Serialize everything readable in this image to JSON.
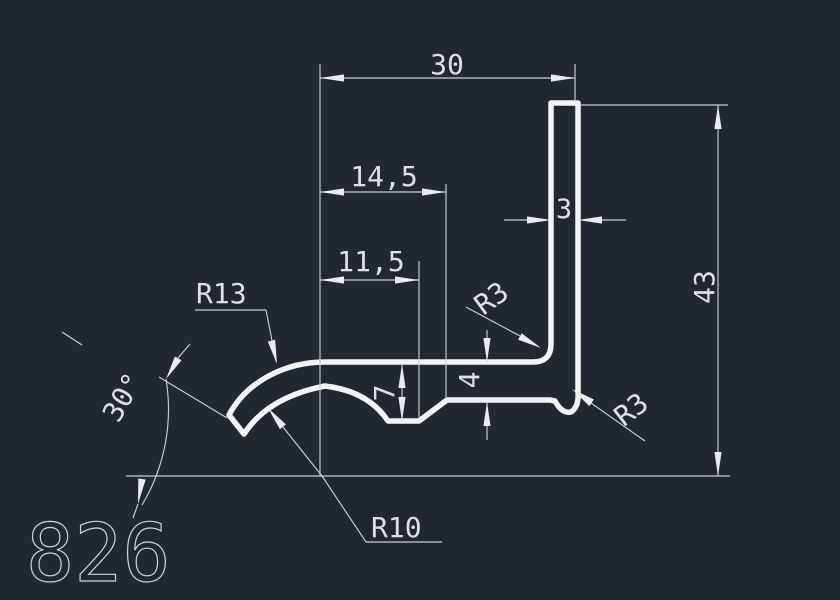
{
  "drawing": {
    "part_number": "826",
    "dimensions": {
      "top_width": "30",
      "mid_width": "14,5",
      "inner_width": "11,5",
      "wall_thickness": "3",
      "total_height": "43",
      "arm_thickness": "4",
      "notch_depth": "7",
      "end_angle": "30°",
      "outer_radius": "R13",
      "inner_radius": "R10",
      "inner_fillet": "R3",
      "outer_fillet": "R3"
    },
    "colors": {
      "background": "#212830",
      "dimension_lines": "#c9ced4",
      "profile_outline": "#f2f3f5",
      "text": "#dde1e6"
    }
  }
}
